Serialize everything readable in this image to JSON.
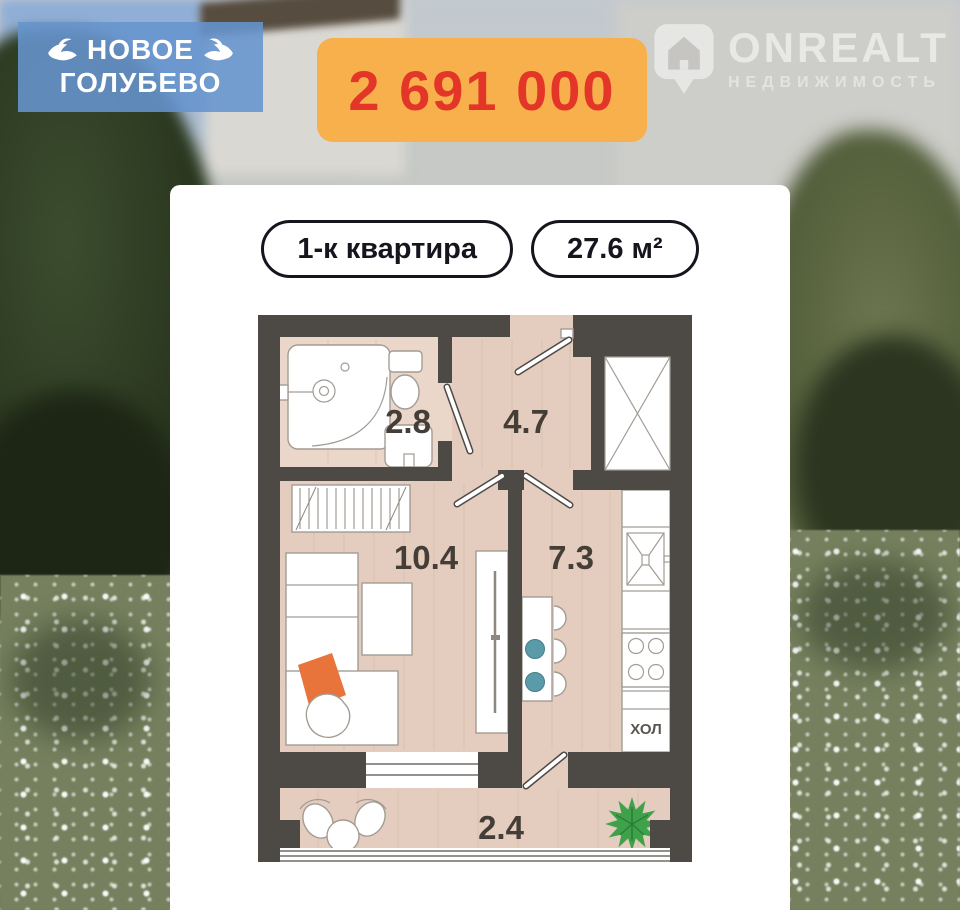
{
  "project_badge": {
    "line1": "НОВОЕ",
    "line2": "ГОЛУБЕВО",
    "icon": "dove",
    "bg_color": "#6594ce",
    "text_color": "#ffffff"
  },
  "price_badge": {
    "value": "2 691 000",
    "bg_color": "#f8b04c",
    "text_color": "#e43529"
  },
  "watermark": {
    "brand": "ONREALT",
    "subtitle": "НЕДВИЖИМОСТЬ",
    "icon": "location-pin-house"
  },
  "listing": {
    "type_label": "1-к квартира",
    "area_label": "27.6 м²"
  },
  "floor_plan": {
    "areas": {
      "bathroom": "2.8",
      "hallway": "4.7",
      "living_room": "10.4",
      "kitchen": "7.3",
      "balcony": "2.4"
    },
    "fridge_label": "ХОЛ",
    "colors": {
      "wall": "#4d4945",
      "floor": "#e4cdbf",
      "blanket_orange": "#e8743c",
      "plant_green": "#3fa24b",
      "plate_teal": "#5b9aa8"
    }
  }
}
